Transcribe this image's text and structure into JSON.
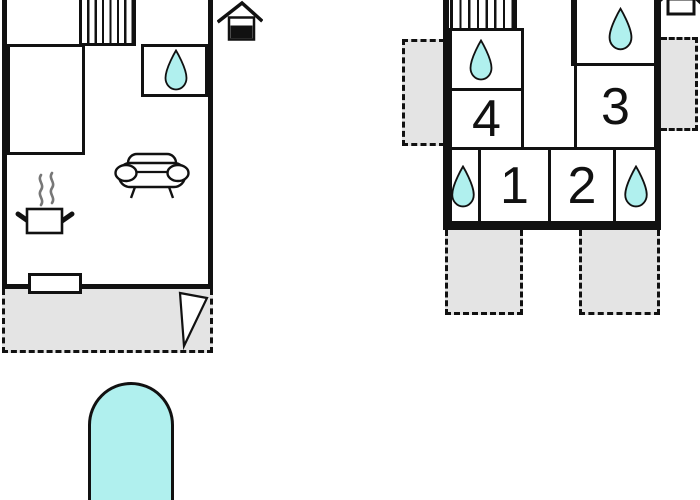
{
  "title": "holiday-home-floor-plan",
  "theme": {
    "accent_cyan": "#b0f0ee",
    "area_gray": "#e4e4e4",
    "wall_black": "#111111",
    "steam_gray": "#777777",
    "page_bg": "#ffffff"
  },
  "floorplans": {
    "ground": {
      "name": "ground-floor",
      "features": [
        "staircase",
        "bathroom-with-water-drop",
        "double-bed",
        "sofa",
        "stove-pot-with-steam",
        "terrace-door",
        "dashed-terrace",
        "door-swing",
        "house-marker-filled-base"
      ],
      "water_drop_count": 1
    },
    "upper_rooms": [
      {
        "label": "4",
        "has_water_drop_room_adjacent": true
      },
      {
        "label": "3",
        "has_water_drop_room_adjacent": true
      },
      {
        "label": "1",
        "has_water_drop_room_adjacent": true
      },
      {
        "label": "2",
        "has_water_drop_room_adjacent": true
      }
    ],
    "upper": {
      "name": "upper-floor",
      "features": [
        "staircase",
        "three-bathrooms-with-water-drops-and-corner-drops",
        "four-dashed-balconies",
        "house-marker-outline"
      ],
      "water_drop_count": 4
    }
  },
  "pool": {
    "present": true,
    "shape": "rounded-top-rectangle",
    "color": "#b0f0ee"
  },
  "icons": {
    "water_drop": "teardrop shape, cyan fill, black outline",
    "staircase": "rectangle with vertical tread lines",
    "bed": "plain rectangle against wall",
    "sofa": "rounded body with two round armrests and legs",
    "stove": "pot with side handles and rising steam",
    "door_swing": "narrow white triangle door leaf",
    "terrace": "gray dashed rectangle",
    "balcony": "gray dashed rectangle",
    "house_ground_marker": "small house, lower half filled black",
    "house_upper_marker": "small house outline, roof cropped at top",
    "pool": "large cyan rounded pool"
  }
}
